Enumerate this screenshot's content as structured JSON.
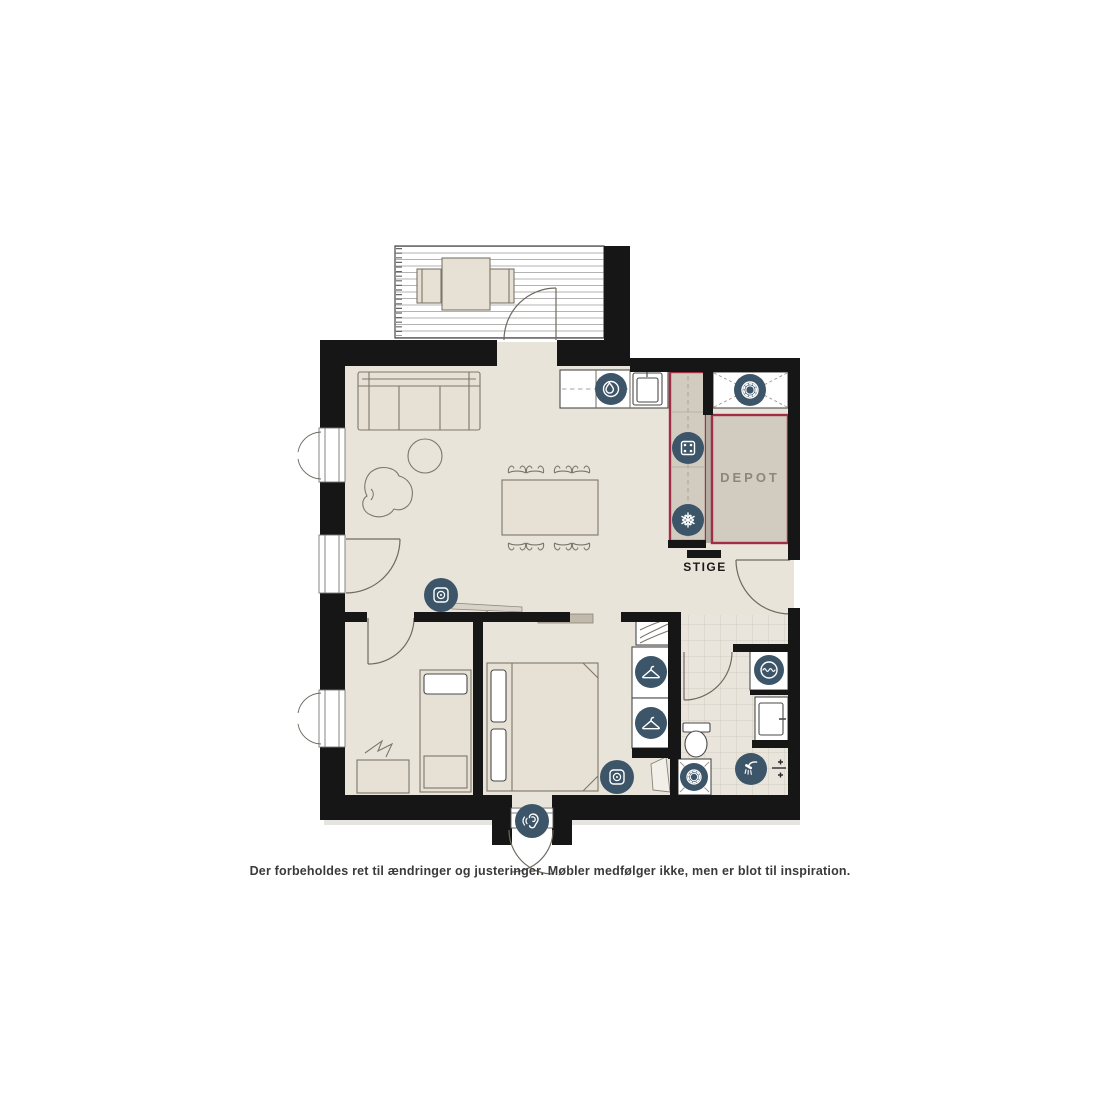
{
  "disclaimer": "Der forbeholdes ret til ændringer og justeringer. Møbler medfølger ikke, men er blot til inspiration.",
  "rooms": {
    "depot_label": "DEPOT",
    "ladder_label": "STIGE"
  },
  "colors": {
    "wall": "#161616",
    "floor": "#e9e4da",
    "tile_floor": "#eae5dc",
    "tile_line": "#d3cdc2",
    "depot_fill": "#d2ccc0",
    "red_outline": "#a22e45",
    "icon_bg": "#3c5568",
    "icon_fg": "#ffffff",
    "furniture_fill": "#e7e1d5",
    "furniture_stroke": "#7d766a",
    "fixture_stroke": "#4a4a4a",
    "door_stroke": "#6f6a60",
    "balcony_line": "#b3b3b3",
    "slider_fill": "#c0b9ac",
    "depot_text": "#8d8679",
    "text_dark": "#3a3a3a"
  },
  "icons": [
    {
      "name": "dishwasher-icon",
      "meaning": "dishwasher"
    },
    {
      "name": "kitchen-sink",
      "meaning": "kitchen sink"
    },
    {
      "name": "stove-icon",
      "meaning": "cooktop / oven"
    },
    {
      "name": "freezer-icon",
      "meaning": "freezer (snowflake)"
    },
    {
      "name": "washing-machine-icon",
      "meaning": "washing machine (reserved spot, top right)"
    },
    {
      "name": "washing-machine-icon-2",
      "meaning": "washing machine (bathroom)"
    },
    {
      "name": "tumble-dryer-icon",
      "meaning": "tumble dryer"
    },
    {
      "name": "wardrobe-hanger-icon",
      "meaning": "built-in wardrobe"
    },
    {
      "name": "wardrobe-hanger-icon-2",
      "meaning": "built-in wardrobe"
    },
    {
      "name": "smoke-detector-icon",
      "meaning": "smoke detector (living room)"
    },
    {
      "name": "smoke-detector-icon-2",
      "meaning": "smoke detector (bedroom)"
    },
    {
      "name": "doorbell-ear-icon",
      "meaning": "doorbell / intercom at entrance"
    },
    {
      "name": "shower-icon",
      "meaning": "shower"
    }
  ]
}
